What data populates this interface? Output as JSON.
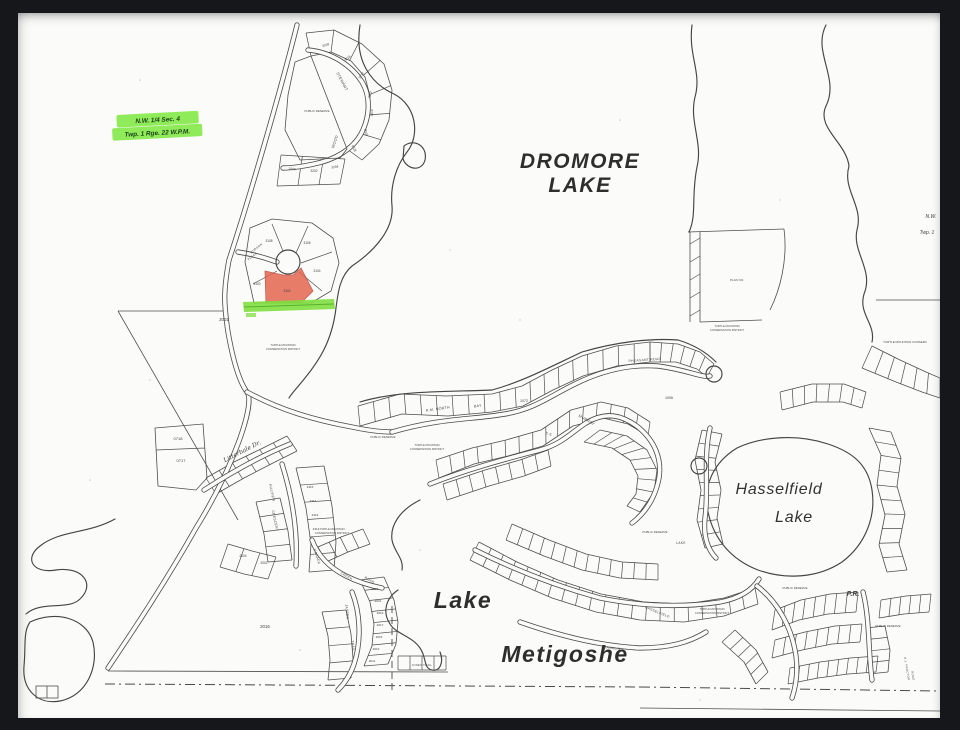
{
  "frame": {
    "color": "#16171b"
  },
  "section_label": {
    "line1": "N.W. 1/4 Sec. 4",
    "line2": "Twp. 1 Rge. 22 W.P.M.",
    "highlight_color": "#85e94b"
  },
  "lakes": {
    "dromore_1": "DROMORE",
    "dromore_2": "LAKE",
    "hasselfield_1": "Hasselfield",
    "hasselfield_2": "Lake",
    "metigoshe_1": "Lake",
    "metigoshe_2": "Metigoshe"
  },
  "corner_note": {
    "line1": "N.W.",
    "line2": "Twp. 1"
  },
  "roads": {
    "stewart": "STEWART",
    "wood": "WOOD",
    "hudson_1": "HUDSON",
    "hudson_2": "PLACE",
    "north_bay_1": "R.M. NORTH",
    "north_bay_2": "BAY",
    "es": "E.S.",
    "murray": "MURRAY",
    "pheasant": "PHEASANT ROAD",
    "lake": "LAKE",
    "hasselfield": "HASSELFIELD",
    "franklin": "FRANKLIN",
    "canada": "CANADA",
    "creek": "CREEK",
    "creek_road": "ROAD",
    "jasper": "JASPER",
    "trail": "TRAIL",
    "hillview": "HILLVIEW",
    "crescent": "CRESCENT",
    "litterbale": "Litterbale Dr.",
    "jones_trail": "JONES TRAIL",
    "proctor_1": "R.J. PROCTOR",
    "proctor_2": "ROAD"
  },
  "labels": {
    "district_line1": "TURTLE MOUNTAIN",
    "district_line2": "CONSERVATION DISTRICT",
    "district_short": "TURTLE MOUNTAIN CONSERV",
    "public_reserve": "PUBLIC RESERVE",
    "plan": "PLAN NO.",
    "pr": "P.R."
  },
  "lots": {
    "stewart": [
      "3218",
      "3216",
      "3214",
      "3212",
      "3210",
      "3208",
      "3206",
      "3204",
      "3202",
      "3200"
    ],
    "hudson": [
      "3108",
      "3106",
      "3104",
      "3102",
      "3100"
    ],
    "jasper": [
      "2023",
      "2021",
      "2019",
      "2017",
      "2015",
      "2013",
      "2011"
    ],
    "hillview": [
      "2315",
      "2314",
      "2313",
      "2312"
    ],
    "parcels": {
      "p2001": "2001",
      "p2016": "2016",
      "p0718": "0718",
      "p0717": "0717",
      "p1072": "1072",
      "p1006": "1006",
      "p2004": "2004",
      "p2002": "2002"
    }
  },
  "highlights": {
    "red_parcel_color": "#e2604a",
    "green_strip_color": "#7fdf3f"
  }
}
